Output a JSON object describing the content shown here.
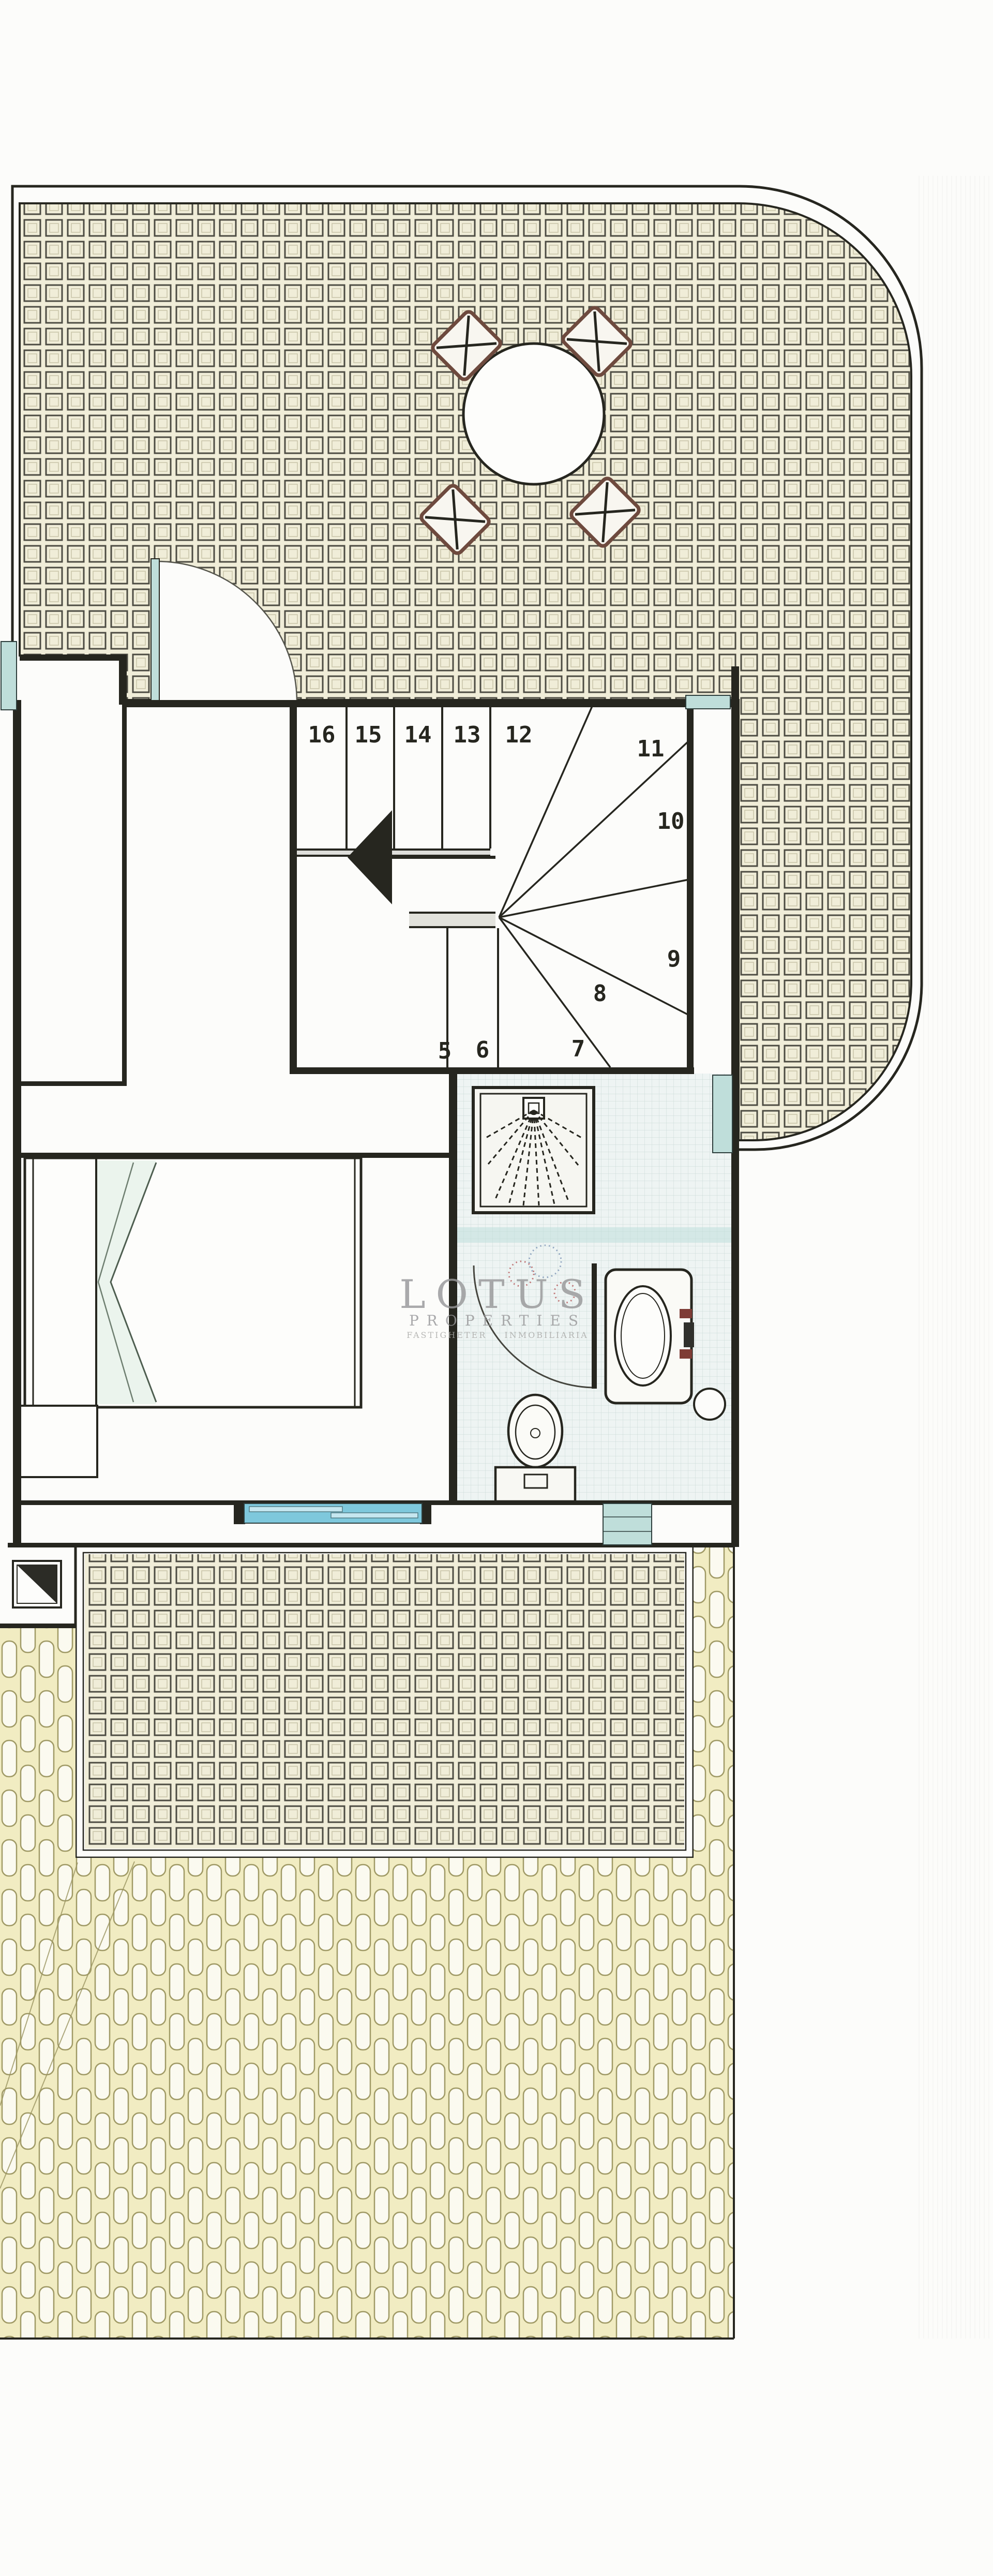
{
  "colors": {
    "paper": "#fcfcfa",
    "ink": "#26261f",
    "hatch_bg": "#f0edd8",
    "hatch_line": "#4c4b42",
    "roof_bg": "#f1ecc2",
    "roof_line": "#a09a66",
    "teal": "#bfdeda",
    "cyan": "#7ec8dc",
    "chair": "#6e4a3e",
    "watermark": "#98989a",
    "swirl_red": "#b86060",
    "swirl_blue": "#8098b8",
    "bed_fold_green": "#e8f2ea"
  },
  "watermark": {
    "name": "LOTUS",
    "subtitle": "PROPERTIES",
    "tagline": "FASTIGHETER INMOBILIARIA"
  },
  "stairs": {
    "steps": [
      {
        "label": "16"
      },
      {
        "label": "15"
      },
      {
        "label": "14"
      },
      {
        "label": "13"
      },
      {
        "label": "12"
      },
      {
        "label": "11"
      },
      {
        "label": "10"
      },
      {
        "label": "9"
      },
      {
        "label": "8"
      },
      {
        "label": "7"
      },
      {
        "label": "6"
      },
      {
        "label": "5"
      }
    ]
  }
}
